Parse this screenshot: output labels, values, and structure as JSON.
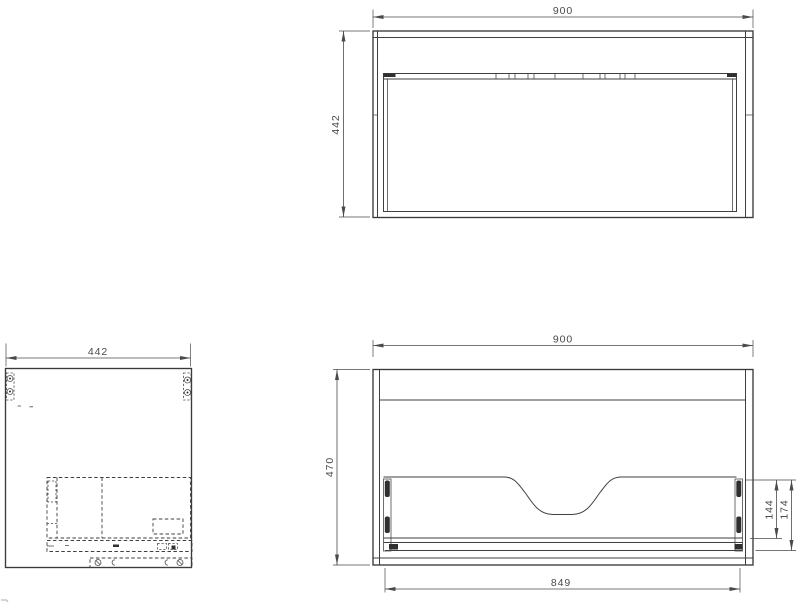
{
  "drawing": {
    "background_color": "#ffffff",
    "line_color": "#3f3f3f",
    "dimension_text_color": "#4a4a4a"
  },
  "views": {
    "top": {
      "width": "900",
      "depth": "442"
    },
    "side": {
      "depth": "442"
    },
    "front": {
      "width": "900",
      "height": "470",
      "inner_width": "849",
      "drawer_front_height": "144",
      "drawer_total_height": "174"
    }
  }
}
